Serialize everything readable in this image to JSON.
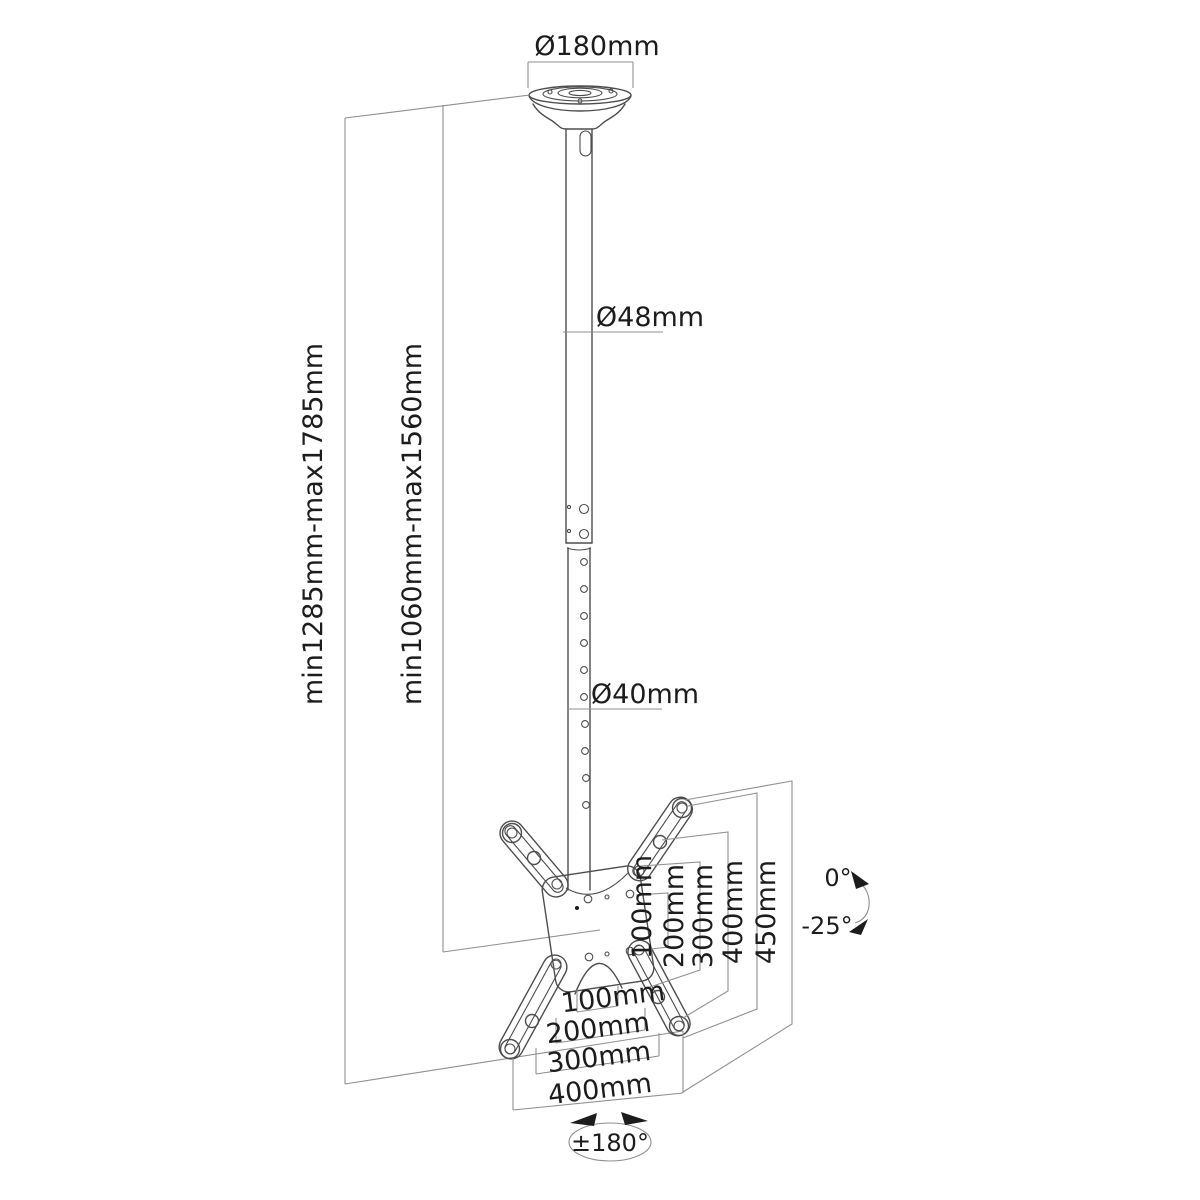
{
  "labels": {
    "plate_diameter": "Ø180mm",
    "upper_pole_diameter": "Ø48mm",
    "lower_pole_diameter": "Ø40mm",
    "total_height_range": "min1285mm-max1785mm",
    "pole_height_range": "min1060mm-max1560mm",
    "vesa_vertical": [
      "100mm",
      "200mm",
      "300mm",
      "400mm",
      "450mm"
    ],
    "vesa_horizontal": [
      "100mm",
      "200mm",
      "300mm",
      "400mm"
    ],
    "tilt_max": "0°",
    "tilt_min": "-25°",
    "rotation": "±180°"
  },
  "colors": {
    "background": "#ffffff",
    "line": "#4d4d4d",
    "dimension_line": "#8f8f8f",
    "text": "#1c1c1c"
  }
}
